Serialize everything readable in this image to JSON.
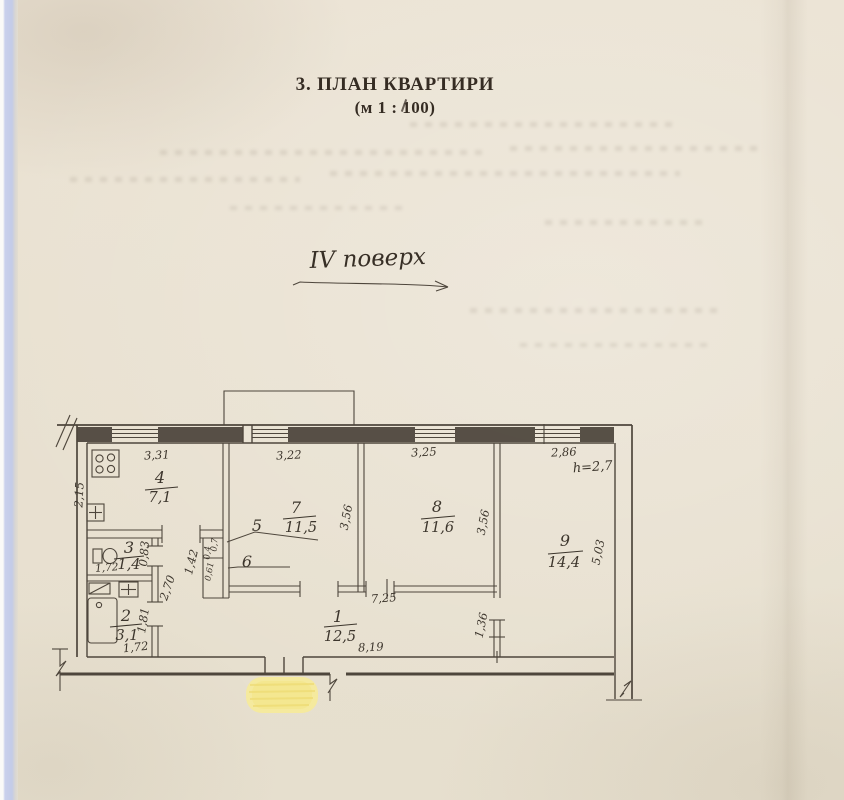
{
  "page": {
    "title": "3. ПЛАН КВАРТИРИ",
    "scale_note": "(м 1 : 100)",
    "floor_note": "IV поверх"
  },
  "plan": {
    "rooms": [
      {
        "number": "1",
        "area": "12,5"
      },
      {
        "number": "2",
        "area": "3,1"
      },
      {
        "number": "3",
        "area": "1,4"
      },
      {
        "number": "4",
        "area": "7,1"
      },
      {
        "number": "5"
      },
      {
        "number": "6"
      },
      {
        "number": "7",
        "area": "11,5"
      },
      {
        "number": "8",
        "area": "11,6"
      },
      {
        "number": "9",
        "area": "14,4"
      }
    ],
    "dims": {
      "top_kitchen": "3,31",
      "top_room7": "3,22",
      "top_room8": "3,25",
      "top_room9": "2,86",
      "ceiling_height": "h=2,7",
      "kitchen_side": "2,15",
      "room8_left": "3,56",
      "room8_right": "3,56",
      "room9_side": "5,03",
      "wc_width": "1,72",
      "wc_side": "0,83",
      "bath_width": "1,72",
      "bath_side": "1,81",
      "corridor_height": "2,70",
      "closet_height": "1,42",
      "closet_top_a": "0,7",
      "closet_top_b": "0,4",
      "closet_bottom": "0,61",
      "hall_top": "7,25",
      "hall_bottom": "8,19",
      "niche_side": "1,36"
    }
  }
}
